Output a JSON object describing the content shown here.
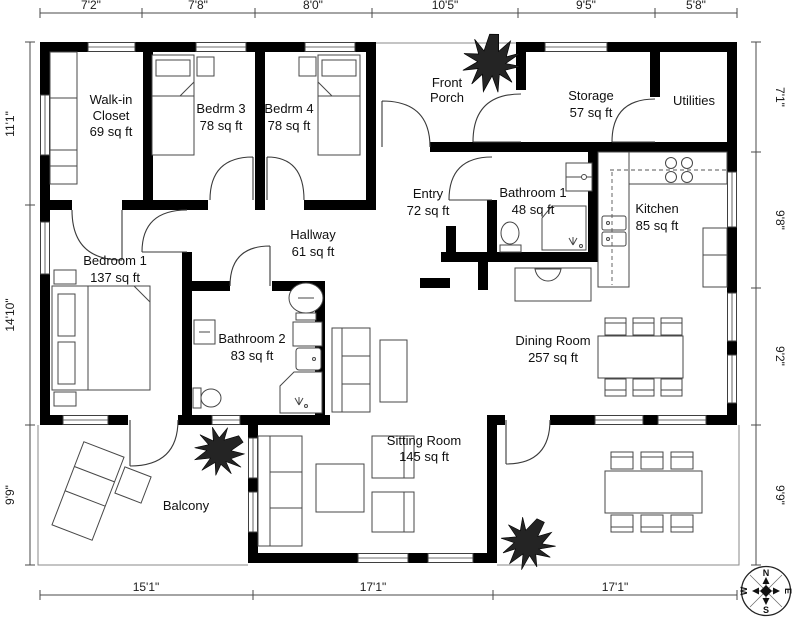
{
  "title": "Floor plan",
  "rooms": {
    "walkin": {
      "line1": "Walk-in",
      "line2": "Closet",
      "area": "69 sq ft"
    },
    "bedrm3": {
      "name": "Bedrm 3",
      "area": "78 sq ft"
    },
    "bedrm4": {
      "name": "Bedrm 4",
      "area": "78 sq ft"
    },
    "front_porch": {
      "line1": "Front",
      "line2": "Porch"
    },
    "storage": {
      "name": "Storage",
      "area": "57 sq ft"
    },
    "utilities": {
      "name": "Utilities"
    },
    "entry": {
      "name": "Entry",
      "area": "72 sq ft"
    },
    "bathroom1": {
      "name": "Bathroom 1",
      "area": "48 sq ft"
    },
    "kitchen": {
      "name": "Kitchen",
      "area": "85 sq ft"
    },
    "hallway": {
      "name": "Hallway",
      "area": "61 sq ft"
    },
    "bedroom1": {
      "name": "Bedroom 1",
      "area": "137 sq ft"
    },
    "bathroom2": {
      "name": "Bathroom 2",
      "area": "83 sq ft"
    },
    "dining": {
      "name": "Dining Room",
      "area": "257 sq ft"
    },
    "sitting": {
      "name": "Sitting Room",
      "area": "145 sq ft"
    },
    "balcony": {
      "name": "Balcony"
    }
  },
  "dimensions": {
    "top": [
      "7'2\"",
      "7'8\"",
      "8'0\"",
      "10'5\"",
      "9'5\"",
      "5'8\""
    ],
    "left": [
      "11'1\"",
      "14'10\"",
      "9'9\""
    ],
    "right": [
      "7'1\"",
      "9'8\"",
      "9'2\"",
      "9'9\""
    ],
    "bottom": [
      "15'1\"",
      "17'1\"",
      "17'1\""
    ]
  },
  "compass": {
    "north": "N",
    "east": "E",
    "south": "S",
    "west": "W"
  },
  "colors": {
    "wall": "#000000",
    "furniture_stroke": "#474747",
    "text": "#111111",
    "tree": "#242424"
  }
}
